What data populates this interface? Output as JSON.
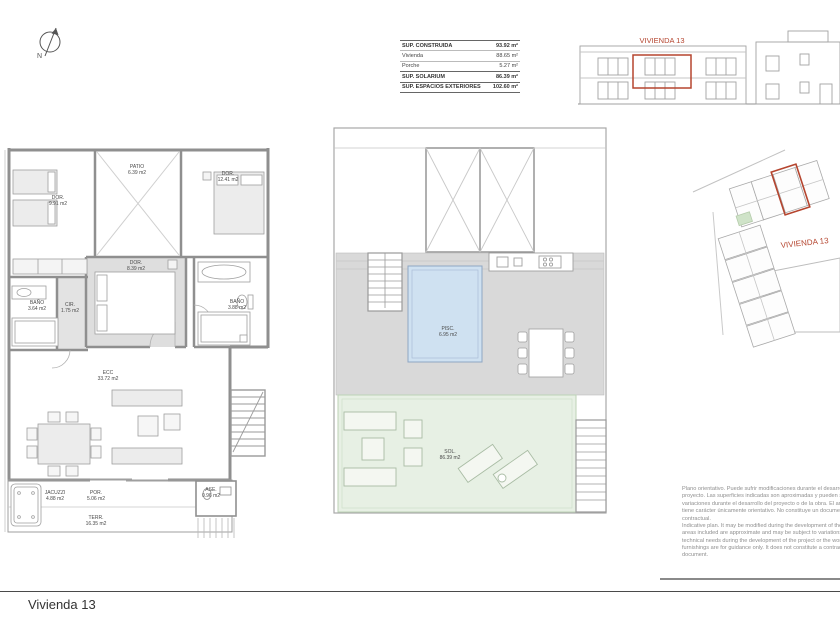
{
  "sheet": {
    "title": "Vivienda 13"
  },
  "compass": {
    "label": "N"
  },
  "colors": {
    "highlight_red": "#b5452f",
    "pool_blue": "#cfe1f1",
    "solarium_green": "#e7f0e4",
    "roof_gray": "#d9d9d9"
  },
  "areas_table": {
    "rows": [
      {
        "label": "SUP. CONSTRUIDA",
        "value": "93.92 m²"
      },
      {
        "label": "Vivienda",
        "value": "88.65 m²"
      },
      {
        "label": "Porche",
        "value": "5.27 m²"
      },
      {
        "label": "SUP. SOLARIUM",
        "value": "86.39 m²"
      },
      {
        "label": "SUP. ESPACIOS EXTERIORES",
        "value": "102.60 m²"
      }
    ]
  },
  "elevation": {
    "label": "VIVIENDA 13"
  },
  "siteplan": {
    "label": "VIVIENDA 13"
  },
  "plan_ground": {
    "rooms": [
      {
        "name": "DOR.",
        "area": "9.91 m2"
      },
      {
        "name": "PATIO",
        "area": "6.39 m2"
      },
      {
        "name": "DOR.",
        "area": "12.41 m2"
      },
      {
        "name": "DOR.",
        "area": "8.39 m2"
      },
      {
        "name": "BAÑO",
        "area": "3.64 m2"
      },
      {
        "name": "CIR.",
        "area": "1.75 m2"
      },
      {
        "name": "BAÑO",
        "area": "3.88 m2"
      },
      {
        "name": "ECC",
        "area": "33.72 m2"
      },
      {
        "name": "JACUZZI",
        "area": "4.88 m2"
      },
      {
        "name": "POR.",
        "area": "5.06 m2"
      },
      {
        "name": "ASE.",
        "area": "0.96 m2"
      },
      {
        "name": "TERR.",
        "area": "16.35 m2"
      }
    ]
  },
  "plan_roof": {
    "rooms": [
      {
        "name": "PISC.",
        "area": "6.95 m2"
      },
      {
        "name": "SOL.",
        "area": "86.39 m2"
      }
    ]
  },
  "disclaimer": {
    "es": "Plano orientativo. Puede sufrir modificaciones durante el desarrollo del proyecto. Las superficies indicadas son aproximadas y pueden sufrir variaciones durante el desarrollo del proyecto o de la obra. El amueblamiento tiene carácter únicamente orientativo. No constituye un documento contractual.",
    "en": "Indicative plan. It may be modified during the development of the project. The areas included are approximate and may be subject to variations due to technical needs during the development of the project or the work. The furnishings are for guidance only. It does not constitute a contractual document."
  }
}
